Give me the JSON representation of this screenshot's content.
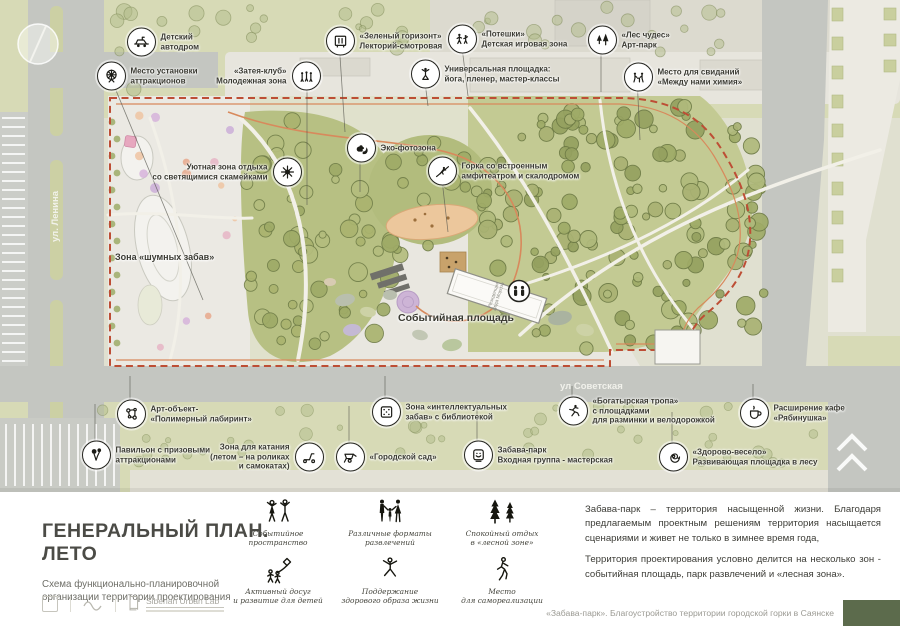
{
  "map": {
    "streets": {
      "lenina": "ул. Ленина",
      "sovetskaya": "ул Советская"
    },
    "building_label": "Резиденция Деда Мороза",
    "zone_labels": [
      {
        "text": "Зона «шумных забав»",
        "x": 115,
        "y": 257,
        "size": 9
      },
      {
        "text": "Событийная площадь",
        "x": 398,
        "y": 318,
        "size": 10.5
      }
    ],
    "callouts": [
      {
        "id": "auto-drome",
        "icon": "car",
        "x": 140,
        "y": 42,
        "side": "r",
        "lines": [
          "Детский",
          "автодром"
        ]
      },
      {
        "id": "attractions-spot",
        "icon": "ferris",
        "x": 110,
        "y": 76,
        "side": "r",
        "lines": [
          "Место установки",
          "аттракционов"
        ],
        "lead": [
          203,
          300
        ]
      },
      {
        "id": "zateya-club",
        "icon": "people",
        "x": 307,
        "y": 76,
        "side": "l",
        "lines": [
          "«Затея-клуб»",
          "Молодежная зона"
        ],
        "lead": [
          307,
          205
        ]
      },
      {
        "id": "green-horizon",
        "icon": "lectory",
        "x": 339,
        "y": 41,
        "side": "r",
        "lines": [
          "«Зеленый горизонт»",
          "Лекторий-смотровая"
        ],
        "lead": [
          345,
          132
        ]
      },
      {
        "id": "poteshki",
        "icon": "kids",
        "x": 461,
        "y": 39,
        "side": "r",
        "lines": [
          "«Потешки»",
          "Детская игровая зона"
        ],
        "lead": [
          468,
          96
        ]
      },
      {
        "id": "universal-ground",
        "icon": "yoga",
        "x": 424,
        "y": 74,
        "side": "r",
        "lines": [
          "Универсальная площадка:",
          "йога, пленер, мастер-классы"
        ],
        "lead": [
          428,
          106
        ]
      },
      {
        "id": "forest-of-wonders",
        "icon": "trees",
        "x": 601,
        "y": 40,
        "side": "r",
        "lines": [
          "«Лес чудес»",
          "Арт-парк"
        ],
        "lead": [
          601,
          92
        ]
      },
      {
        "id": "dating-place",
        "icon": "date",
        "x": 637,
        "y": 77,
        "side": "r",
        "lines": [
          "Место для свиданий",
          "«Между нами химия»"
        ],
        "lead": [
          640,
          140
        ]
      },
      {
        "id": "eco-photozone",
        "icon": "squirrel",
        "x": 360,
        "y": 148,
        "side": "r",
        "lines": [
          "Эко-фотозона"
        ],
        "lead": [
          360,
          192
        ]
      },
      {
        "id": "cozy-rest-zone",
        "icon": "sparkle",
        "x": 288,
        "y": 172,
        "side": "l",
        "lines": [
          "Уютная зона отдыха",
          "со светящимися скамейками"
        ]
      },
      {
        "id": "hill-amphitheatre",
        "icon": "climber",
        "x": 441,
        "y": 171,
        "side": "r",
        "lines": [
          "Горка со встроенным",
          "амфитеатром и скалодромом"
        ],
        "lead": [
          448,
          232
        ]
      },
      {
        "id": "polymer-labyrinth",
        "icon": "molecule",
        "x": 130,
        "y": 414,
        "side": "r",
        "lines": [
          "Арт-объект-",
          "«Полимерный лабиринт»"
        ],
        "lead": [
          130,
          376
        ]
      },
      {
        "id": "intellectual-zone",
        "icon": "dice",
        "x": 385,
        "y": 412,
        "side": "r",
        "lines": [
          "Зона «интеллектуальных",
          "забав» с библиотекой"
        ],
        "lead": [
          385,
          376
        ]
      },
      {
        "id": "prize-pavilion",
        "icon": "balloons",
        "x": 95,
        "y": 455,
        "side": "r",
        "lines": [
          "Павильон с призовыми",
          "аттракционами"
        ],
        "lead": [
          95,
          404
        ]
      },
      {
        "id": "riding-zone",
        "icon": "scooter",
        "x": 310,
        "y": 457,
        "side": "l",
        "lines": [
          "Зона для катания",
          "(летом – на роликах",
          "и самокатах)"
        ]
      },
      {
        "id": "city-garden",
        "icon": "wheelbarrow",
        "x": 349,
        "y": 457,
        "side": "r",
        "lines": [
          "«Городской сад»"
        ],
        "lead": [
          349,
          406
        ]
      },
      {
        "id": "entrance-group",
        "icon": "mask",
        "x": 477,
        "y": 455,
        "side": "r",
        "lines": [
          "Забава-парк",
          "Входная группа - мастерская"
        ],
        "lead": [
          477,
          406
        ]
      },
      {
        "id": "bogatyr-trail",
        "icon": "runner",
        "x": 572,
        "y": 411,
        "side": "r",
        "lines": [
          "«Богатырская тропа»",
          "с площадками",
          "для разминки и велодорожкой"
        ],
        "lead": [
          572,
          386
        ]
      },
      {
        "id": "cafe-ryabinushka",
        "icon": "cup",
        "x": 753,
        "y": 413,
        "side": "r",
        "lines": [
          "Расширение кафе",
          "«Рябинушка»"
        ],
        "lead": [
          753,
          384
        ]
      },
      {
        "id": "zdorovo-veselo",
        "icon": "spiral",
        "x": 672,
        "y": 457,
        "side": "r",
        "lines": [
          "«Здорово-весело»",
          "Развивающая площадка в лесу"
        ],
        "lead": [
          672,
          412
        ]
      }
    ]
  },
  "title_block": {
    "title": "ГЕНЕРАЛЬНЫЙ ПЛАН. ЛЕТО",
    "subtitle": "Схема функционально-планировочной организации территории проектирования",
    "lab_name": "Siberian Urban Lab"
  },
  "legend": {
    "items": [
      {
        "icon": "dancers",
        "lines": [
          "Событийное",
          "пространство"
        ]
      },
      {
        "icon": "family",
        "lines": [
          "Различные форматы",
          "развлечений"
        ]
      },
      {
        "icon": "pines",
        "lines": [
          "Спокойный отдых",
          "в «лесной зоне»"
        ]
      },
      {
        "icon": "kitekids",
        "lines": [
          "Активный досуг",
          "и развитие для детей"
        ]
      },
      {
        "icon": "jumper",
        "lines": [
          "Поддержание",
          "здорового образа жизни"
        ]
      },
      {
        "icon": "self",
        "lines": [
          "Место",
          "для самореализации"
        ]
      }
    ]
  },
  "description": {
    "p1": "Забава-парк – территория насыщенной жизни. Благодаря предлагаемым проектным решениям территория насыщается  сценариями и живет не только в зимнее время года,",
    "p2": "Территория проектирования условно делится на несколько зон - событийная площадь, парк развлечений и «лесная зона»."
  },
  "footer": {
    "caption": "«Забава-парк». Благоустройство территории городской горки в Саянске",
    "accent_color": "#5c6b4c"
  },
  "colors": {
    "boundary_dash": "#bd4e35",
    "boundary_inner": "#d8895c",
    "road": "#c4c6c1",
    "green": "#d7dab6",
    "forest": "#c3ca93"
  }
}
